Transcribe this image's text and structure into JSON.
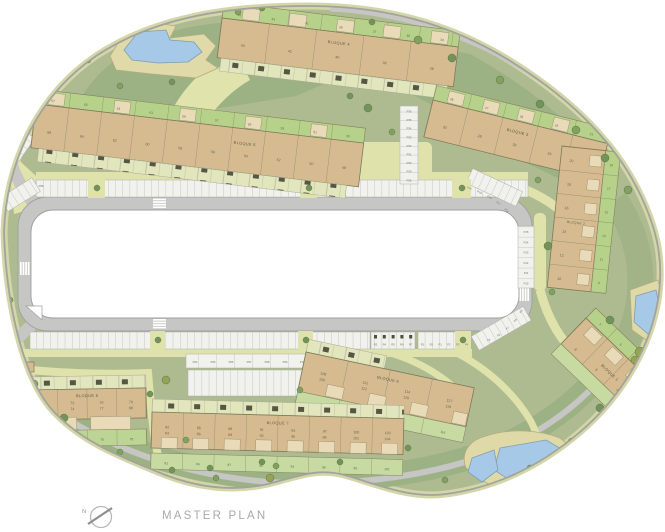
{
  "title": "MASTER PLAN",
  "compass": {
    "north": "N"
  },
  "blocks": {
    "b1": {
      "label": "BLOQUE 1",
      "units": [
        "8",
        "6",
        "4",
        "2"
      ],
      "plots": [
        "7",
        "5",
        "3",
        "1"
      ]
    },
    "b2": {
      "label": "BLOQUE 2",
      "units_left": [
        "20",
        "18",
        "16",
        "14",
        "12",
        "10"
      ],
      "units_right": [
        "19",
        "17",
        "15",
        "13",
        "11",
        "9"
      ]
    },
    "b3": {
      "label": "BLOQUE 3",
      "units": [
        "30",
        "28",
        "26",
        "24",
        "22"
      ],
      "plots": [
        "29",
        "27",
        "25",
        "23",
        "21"
      ]
    },
    "b4": {
      "label": "BLOQUE 4",
      "units": [
        "44",
        "42",
        "40",
        "38",
        "36"
      ],
      "plots": [
        "45",
        "43",
        "41",
        "39",
        "37",
        "35",
        "33"
      ]
    },
    "b5": {
      "label": "BLOQUE 5",
      "units": [
        "66",
        "64",
        "62",
        "60",
        "58",
        "56",
        "54",
        "52",
        "50",
        "48"
      ],
      "plots": [
        "67",
        "65",
        "63",
        "61",
        "59",
        "57",
        "55",
        "53",
        "51",
        "49"
      ]
    },
    "b6": {
      "label": "BLOQUE 6",
      "units_upper": [
        "108",
        "111",
        "114",
        "117"
      ],
      "units_lower": [
        "109",
        "112",
        "115",
        "118"
      ],
      "gardens": [
        "107",
        "110",
        "113",
        "116"
      ]
    },
    "b7": {
      "label": "BLOQUE 7",
      "units_upper": [
        "82",
        "85",
        "88",
        "91",
        "94",
        "97",
        "100",
        "103"
      ],
      "units_lower": [
        "83",
        "86",
        "89",
        "92",
        "95",
        "98",
        "101",
        "104"
      ],
      "gardens": [
        "81",
        "84",
        "87",
        "90",
        "93",
        "96",
        "99",
        "102"
      ]
    },
    "b8": {
      "label": "BLOQUE 8",
      "units_upper": [
        "70",
        "73",
        "76",
        "79"
      ],
      "units_lower": [
        "71",
        "74",
        "77",
        "80"
      ],
      "gardens": [
        "69",
        "72",
        "75",
        "78"
      ]
    }
  },
  "parking": {
    "right_column": [
      "P15",
      "P14",
      "P13",
      "P12",
      "P11",
      "P10"
    ],
    "top_right_curve": [
      "P20",
      "P19",
      "P18",
      "P17",
      "P16"
    ],
    "mid_column": [
      "P36",
      "P35",
      "P34",
      "P33",
      "P32",
      "P31",
      "P30",
      "P29",
      "P28"
    ],
    "strip_94_102": [
      "P94",
      "P95",
      "P96",
      "P97",
      "P98",
      "P99",
      "P100",
      "P101",
      "P102"
    ],
    "reserved_group": [
      "R3",
      "R4",
      "R5",
      "R6",
      "R7"
    ],
    "mixed_group": [
      "R1",
      "R2",
      "P1",
      "P2",
      "P3",
      "P4"
    ],
    "bottom_right_curve": [
      "P5",
      "P6",
      "P7",
      "P8",
      "P9"
    ],
    "far_left_label": "P98"
  },
  "colors": {
    "building": "#d6bb90",
    "patio": "#e9dbb8",
    "plot_green": "#b6d189",
    "lawn": "#aebb90",
    "lawn_dark": "#9db284",
    "path": "#e0e4ac",
    "road": "#c6c6c4",
    "pool": "#a5c9e6",
    "deck": "#e0d9a8",
    "tree": "#74935a"
  }
}
